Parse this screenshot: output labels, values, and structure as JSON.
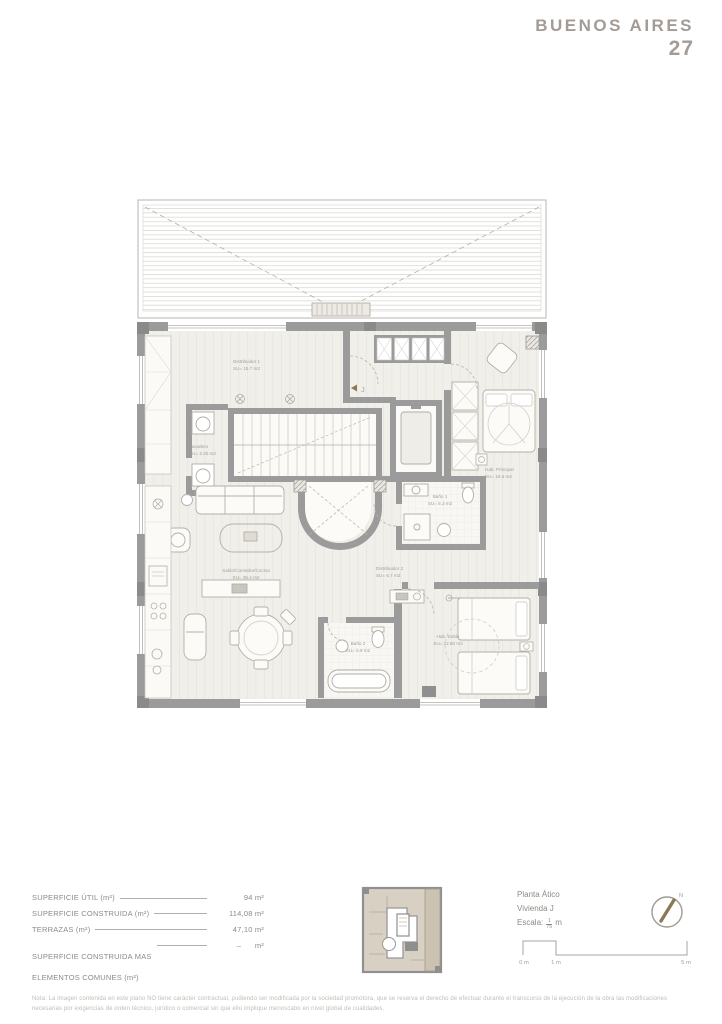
{
  "brand": {
    "name": "BUENOS AIRES",
    "number": "27"
  },
  "plan": {
    "entrance_label": "J",
    "rooms": [
      {
        "name": "Distribuidor 1",
        "area": "SU= 15.7 m2"
      },
      {
        "name": "Lavadero",
        "area": "SU= 2.20 m2"
      },
      {
        "name": "Hab. Principal",
        "area": "SU= 16.5 m2"
      },
      {
        "name": "Baño 1",
        "area": "SU= 5.3 m2"
      },
      {
        "name": "Salón/Comedor/Cocina",
        "area": "SU= 35.4 m2"
      },
      {
        "name": "Distribuidor 2",
        "area": "SU= 6.7 m2"
      },
      {
        "name": "Baño 2",
        "area": "SU= 5.9 m2"
      },
      {
        "name": "Hab. Doble",
        "area": "SU= 12.80 m2"
      }
    ]
  },
  "areas_table": {
    "rows": [
      {
        "label": "SUPERFICIE ÚTIL (m²)",
        "value": "94 m²"
      },
      {
        "label": "SUPERFICIE CONSTRUIDA (m²)",
        "value": "114,08 m²"
      },
      {
        "label": "TERRAZAS (m²)",
        "value": "47,10 m²"
      },
      {
        "label": "SUPERFICIE CONSTRUIDA MAS",
        "label2": "ELEMENTOS COMUNES (m²)",
        "value": "–      m²"
      }
    ]
  },
  "plan_info": {
    "floor": "Planta Ático",
    "unit": "Vivienda J",
    "scale_label": "Escala:",
    "scale_numerator": "1",
    "scale_denominator": "75",
    "scale_unit": "m"
  },
  "compass": {
    "north_label": "N"
  },
  "scale_bar": {
    "labels": [
      "0 m",
      "1 m",
      "5 m"
    ]
  },
  "footnote": "Nota: La imagen contenida en este plano NO tiene carácter contractual, pudiendo ser modificada por la sociedad promotora, que se reserva el derecho de efectuar durante el transcurso de la ejecución de la obra las modificaciones necesarias por exigencias de orden técnico, jurídico o comercial sin que ello implique menoscabo en nivel global de cualidades."
}
